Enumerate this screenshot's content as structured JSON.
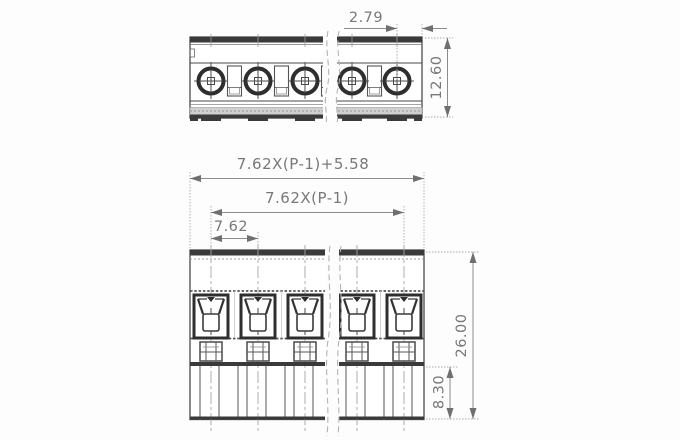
{
  "drawing": {
    "type": "technical-dimension-drawing",
    "views": [
      "top-view",
      "front-view"
    ],
    "dimensions": {
      "screw_offset": "2.79",
      "top_height": "12.60",
      "overall_width": "7.62X(P-1)+5.58",
      "centers_width": "7.62X(P-1)",
      "pitch": "7.62",
      "total_height": "26.00",
      "base_height": "8.30"
    },
    "colors": {
      "body_line": "#4a4a4a",
      "dark_fill": "#3a3a3a",
      "dim_line": "#8c8c8c",
      "dim_text": "#787878",
      "centerline": "#a3a3a3",
      "break_line": "#b3b3b3"
    }
  }
}
